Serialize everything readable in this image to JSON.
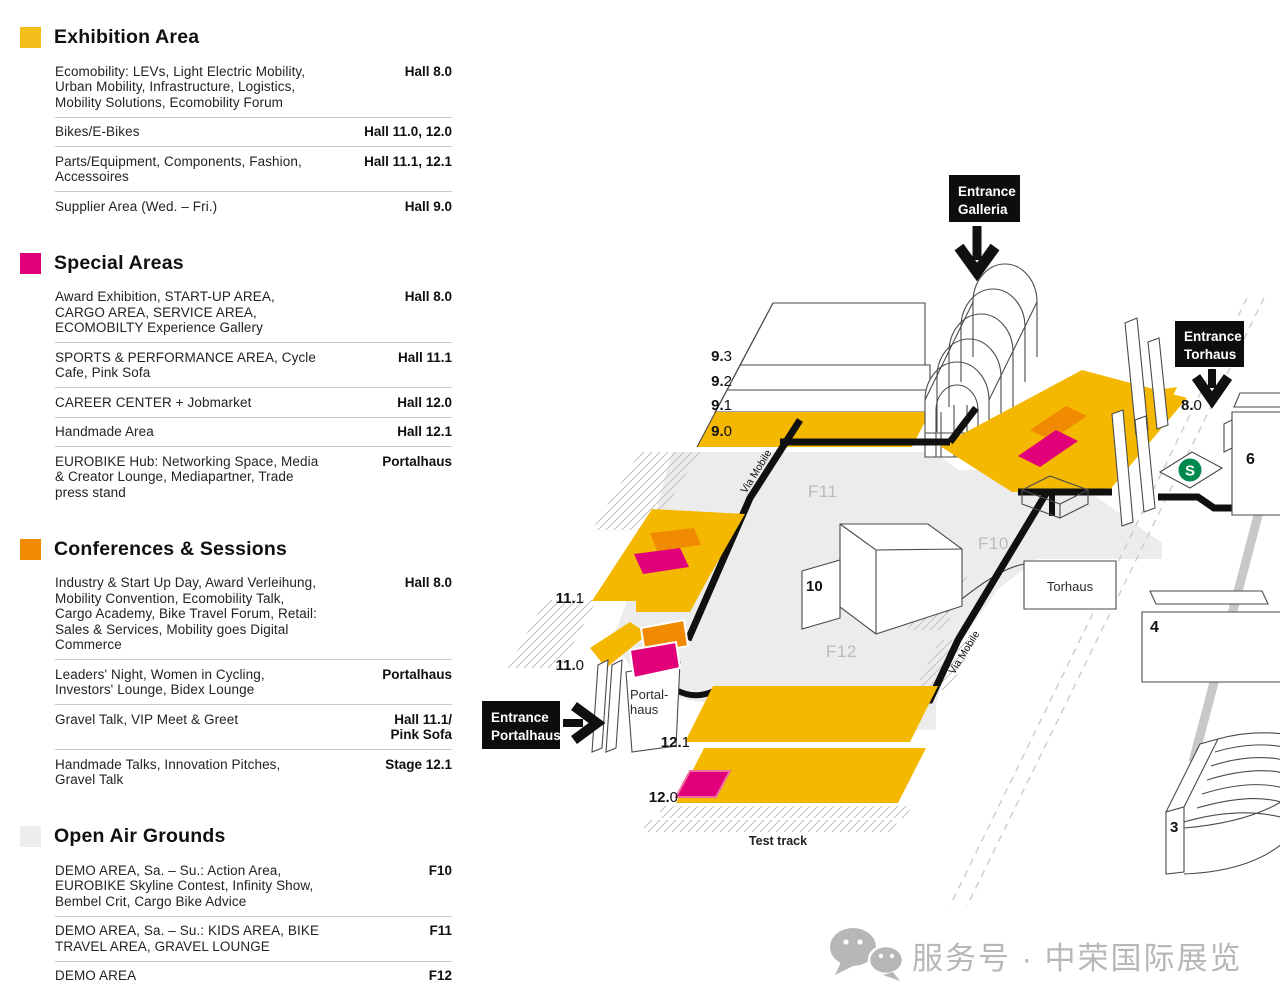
{
  "legend": {
    "sections": [
      {
        "title": "Exhibition Area",
        "color": "#F2BE19",
        "rows": [
          {
            "label": "Ecomobility: LEVs, Light Electric Mobility, Urban Mobility, Infrastructure, Logistics, Mobility Solutions, Ecomobility Forum",
            "location": "Hall 8.0"
          },
          {
            "label": "Bikes/E-Bikes",
            "location": "Hall 11.0, 12.0"
          },
          {
            "label": "Parts/Equipment, Components, Fashion, Accessoires",
            "location": "Hall 11.1, 12.1"
          },
          {
            "label": "Supplier Area (Wed. – Fri.)",
            "location": "Hall 9.0"
          }
        ]
      },
      {
        "title": "Special Areas",
        "color": "#E2007A",
        "rows": [
          {
            "label": "Award Exhibition, START-UP AREA, CARGO AREA, SERVICE AREA, ECOMOBILTY Experience Gallery",
            "location": "Hall 8.0"
          },
          {
            "label": "SPORTS & PERFORMANCE AREA, Cycle Cafe, Pink Sofa",
            "location": "Hall 11.1"
          },
          {
            "label": "CAREER CENTER + Jobmarket",
            "location": "Hall 12.0"
          },
          {
            "label": "Handmade Area",
            "location": "Hall 12.1"
          },
          {
            "label": "EUROBIKE Hub: Networking Space, Media & Creator Lounge, Mediapartner, Trade press stand",
            "location": "Portalhaus"
          }
        ]
      },
      {
        "title": "Conferences & Sessions",
        "color": "#F08A00",
        "rows": [
          {
            "label": "Industry & Start Up Day, Award Verleihung, Mobility Convention, Ecomobility Talk, Cargo Academy, Bike Travel Forum, Retail: Sales & Services, Mobility goes Digital Commerce",
            "location": "Hall 8.0"
          },
          {
            "label": "Leaders' Night, Women in Cycling, Investors' Lounge, Bidex Lounge",
            "location": "Portalhaus"
          },
          {
            "label": "Gravel Talk, VIP Meet & Greet",
            "location": "Hall 11.1/\nPink Sofa"
          },
          {
            "label": "Handmade Talks, Innovation Pitches, Gravel Talk",
            "location": "Stage 12.1"
          }
        ]
      },
      {
        "title": "Open Air Grounds",
        "color": "#EDEDED",
        "rows": [
          {
            "label": "DEMO AREA, Sa. – Su.: Action Area, EUROBIKE Skyline Contest, Infinity Show, Bembel Crit, Cargo Bike Advice",
            "location": "F10"
          },
          {
            "label": "DEMO AREA, Sa. – Su.: KIDS AREA, BIKE TRAVEL AREA, GRAVEL LOUNGE",
            "location": "F11"
          },
          {
            "label": "DEMO AREA",
            "location": "F12"
          }
        ]
      }
    ]
  },
  "map": {
    "labels": {
      "h93b": "9.",
      "h93r": "3",
      "h92b": "9.",
      "h92r": "2",
      "h91b": "9.",
      "h91r": "1",
      "h90b": "9.",
      "h90r": "0",
      "h111b": "11.",
      "h111r": "1",
      "h110b": "11.",
      "h110r": "0",
      "h121b": "12.",
      "h121r": "1",
      "h120b": "12.",
      "h120r": "0",
      "h80b": "8.",
      "h80r": "0",
      "b10": "10",
      "h6": "6",
      "h4": "4",
      "h3": "3",
      "f10": "F10",
      "f11": "F11",
      "f12": "F12",
      "torhaus": "Torhaus",
      "portalhaus1": "Portal-",
      "portalhaus2": "haus",
      "via_mobile": "Via Mobile",
      "test_track": "Test track",
      "sbahn": "S"
    },
    "entrances": {
      "galleria": {
        "line1": "Entrance",
        "line2": "Galleria"
      },
      "torhaus": {
        "line1": "Entrance",
        "line2": "Torhaus"
      },
      "portalhaus": {
        "line1": "Entrance",
        "line2": "Portalhaus"
      }
    },
    "colors": {
      "hall_yellow": "#F5B800",
      "special_magenta": "#E2007A",
      "conference_orange": "#F08A00",
      "open_air_gray": "#ECECEC",
      "sbahn_green": "#00894E"
    }
  },
  "watermark": {
    "icon": "wechat-icon",
    "text": "服务号 · 中荣国际展览"
  }
}
